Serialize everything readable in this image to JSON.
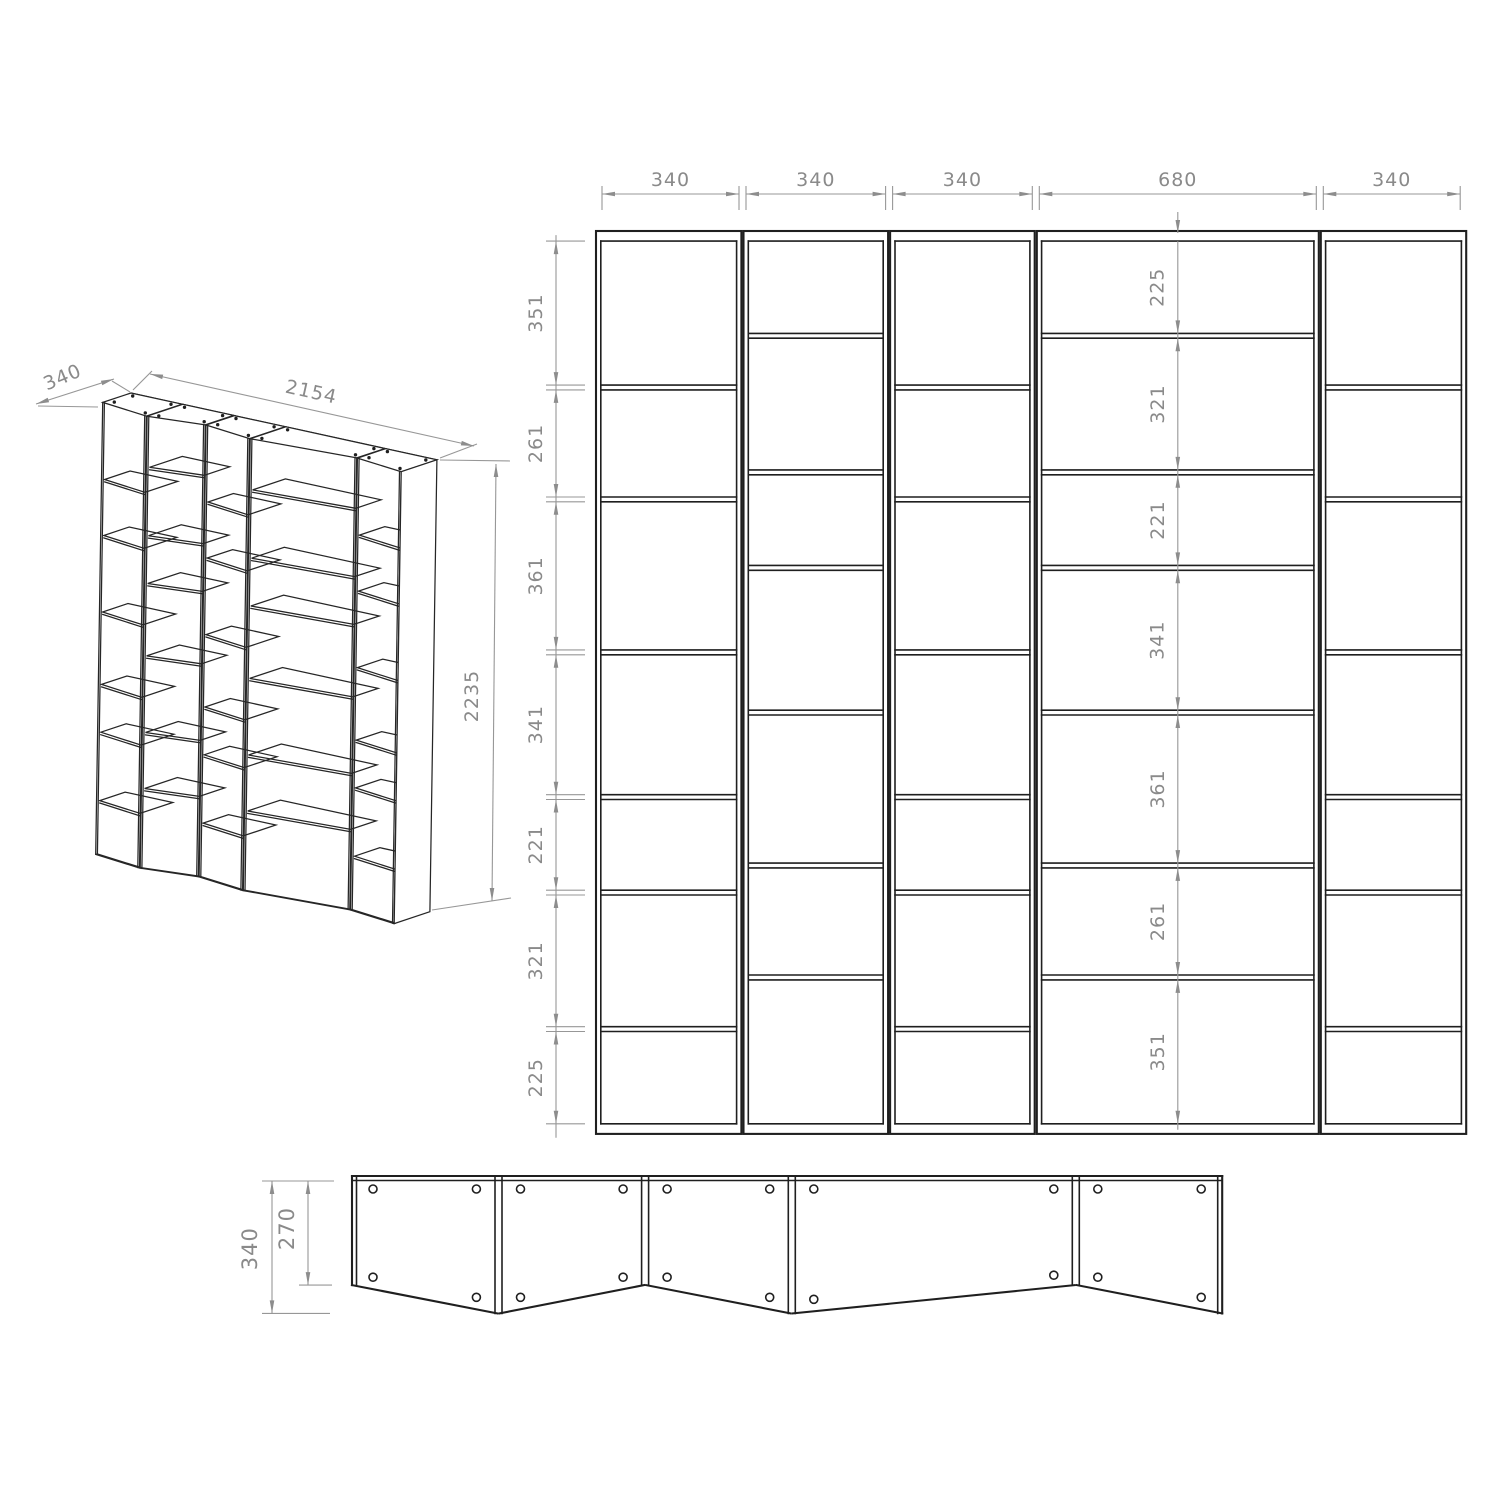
{
  "title": "Zigzag bookshelf technical drawing",
  "units": "mm",
  "colors": {
    "background": "#ffffff",
    "geometry_line": "#1f1f1f",
    "dimension_line": "#979797",
    "dimension_text": "#8a8a8a"
  },
  "diagram_data": {
    "type": "technical-drawing",
    "views": {
      "isometric": {
        "dim_labels": {
          "depth": "340",
          "width": "2154",
          "height": "2235"
        }
      },
      "front_elevation": {
        "total_width_mm": 2154,
        "total_height_mm": 2235,
        "column_widths_mm": [
          340,
          340,
          340,
          680,
          340
        ],
        "column_width_labels": [
          "340",
          "340",
          "340",
          "680",
          "340"
        ],
        "left_shelf_chain_mm": [
          351,
          261,
          361,
          341,
          221,
          321,
          225
        ],
        "left_shelf_chain_labels": [
          "351",
          "261",
          "361",
          "341",
          "221",
          "321",
          "225"
        ],
        "middle_shelf_chain_mm": [
          225,
          321,
          221,
          341,
          361,
          261,
          351
        ],
        "middle_shelf_chain_labels": [
          "225",
          "321",
          "221",
          "341",
          "361",
          "261",
          "351"
        ]
      },
      "plan": {
        "depth_labels": {
          "total": "340",
          "side_panel": "270"
        },
        "boundary_depths_mm": [
          270,
          340,
          270,
          340,
          270,
          340
        ],
        "holes_per_panel": 4
      }
    }
  }
}
